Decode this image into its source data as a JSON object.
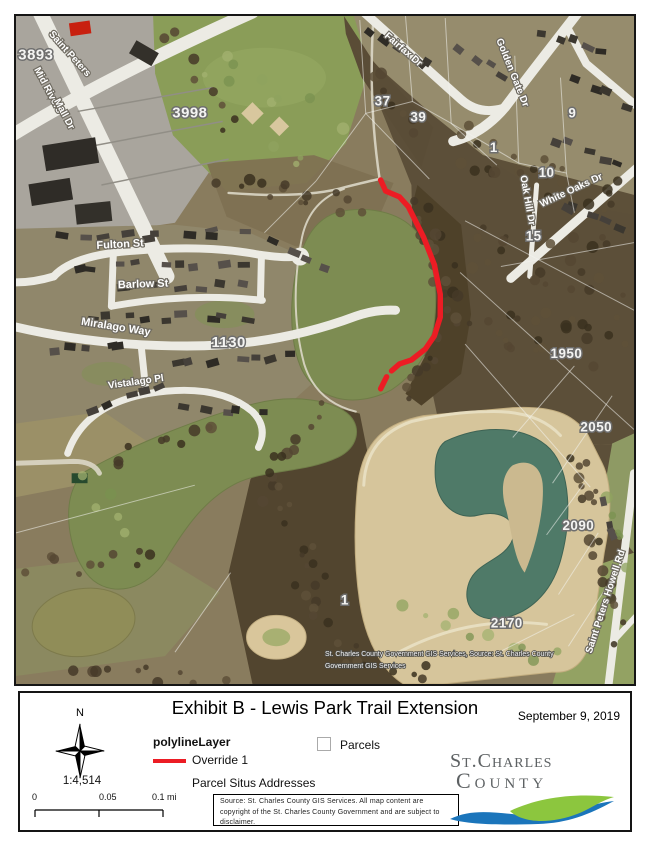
{
  "page": {
    "title": "Exhibit B - Lewis Park Trail Extension",
    "date": "September 9, 2019"
  },
  "map": {
    "trail_color": "#ec1c24",
    "attribution": {
      "line1": "St. Charles County Government GIS Services, Source: St. Charles County",
      "line2": "Government GIS Services"
    },
    "parcels": {
      "p3893": "3893",
      "p3998": "3998",
      "p37": "37",
      "p39": "39",
      "p1_woods": "1",
      "p9": "9",
      "p10": "10",
      "p15": "15",
      "p1130": "1130",
      "p1950": "1950",
      "p2050": "2050",
      "p2090": "2090",
      "p1_lake": "1",
      "p2170": "2170"
    },
    "streets": {
      "saint_peters": "Saint Peters",
      "mid_rivers": "Mid Rivers",
      "mall_dr": "Mall Dr",
      "fairfax": "Fairfax Dr",
      "golden_gate": "Golden Gate Dr",
      "oak_hill": "Oak Hill Dr",
      "white_oaks": "White Oaks Dr",
      "fulton": "Fulton St",
      "barlow": "Barlow St",
      "miralago": "Miralago Way",
      "vistalago": "Vistalago Pl",
      "howell": "Saint Peters Howell Rd"
    }
  },
  "legend": {
    "north_label": "N",
    "scale_ratio": "1:4,514",
    "scale_bar": {
      "t0": "0",
      "t1": "0.05",
      "t2": "0.1 mi"
    },
    "layer_group": "polylineLayer",
    "override": "Override 1",
    "parcels": "Parcels",
    "situs": "Parcel Situs Addresses",
    "source": "Source: St. Charles County GIS Services.  All map content are copyright of the St. Charles County Government and are subject to disclaimer.",
    "logo": {
      "line1": "St.Charles",
      "line2": "County",
      "blue": "#1b75bb",
      "green": "#8cc63e"
    }
  }
}
